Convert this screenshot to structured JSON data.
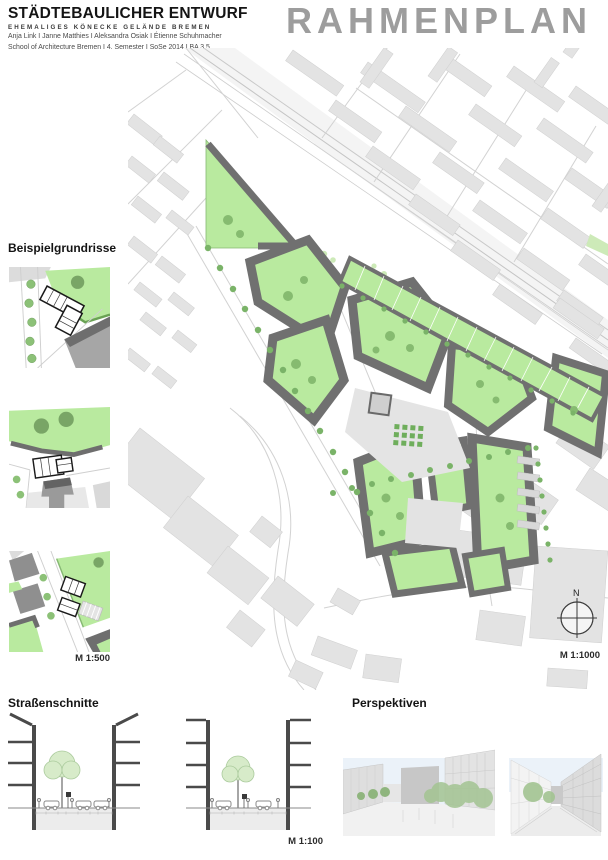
{
  "header": {
    "title": "STÄDTEBAULICHER ENTWURF",
    "subtitle": "EHEMALIGES  KÖNECKE  GELÄNDE  BREMEN",
    "authors": "Anja Link I Janne Matthies I Aleksandra Osiak I Étienne Schuhmacher",
    "school": "School of Architecture Bremen  I  4. Semester  I  SoSe 2014  I  BA 3.5"
  },
  "plan_title": "RAHMENPLAN",
  "examples": {
    "heading": "Beispielgrundrisse",
    "scale_label": "M 1:500"
  },
  "map": {
    "scale_label": "M 1:1000",
    "north_label": "N"
  },
  "sections": {
    "heading": "Straßenschnitte",
    "scale_label": "M 1:100"
  },
  "perspectives": {
    "heading": "Perspektiven"
  },
  "colors": {
    "courtyard_green": "#b9ea9f",
    "tree_green": "#7ab368",
    "new_building_gray": "#707070",
    "context_gray": "#e3e3e3",
    "title_gray": "#9d9d9d"
  }
}
